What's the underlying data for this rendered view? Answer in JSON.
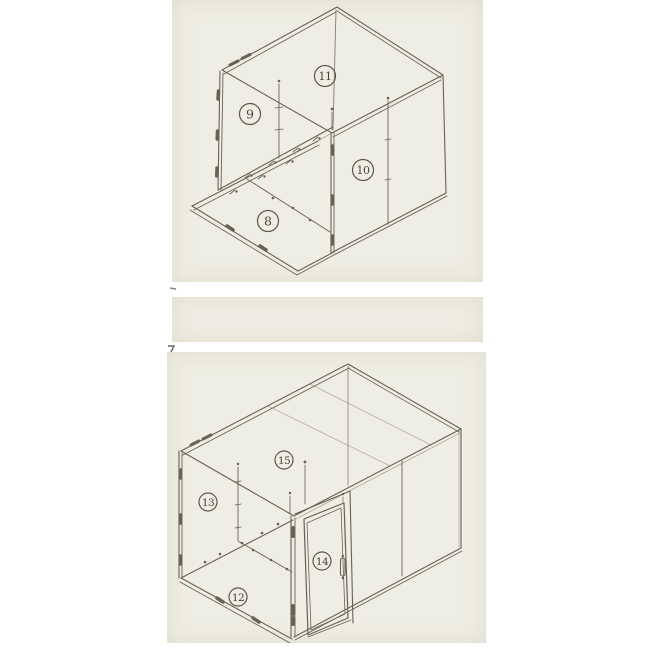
{
  "document": {
    "kind": "technical line drawing, two isometric views of panel-built cold room",
    "background_color": "#ffffff",
    "paper_color": "#efeee4",
    "line_color": "#5b574b"
  },
  "figure_top": {
    "description": "exploded isometric view: floor panel, rear wall, side wall, roof",
    "callouts": [
      {
        "label": "8"
      },
      {
        "label": "9"
      },
      {
        "label": "10"
      },
      {
        "label": "11"
      }
    ]
  },
  "figure_bottom": {
    "description": "assembled isometric view with hinged door",
    "callouts": [
      {
        "label": "12"
      },
      {
        "label": "13"
      },
      {
        "label": "14"
      },
      {
        "label": "15"
      }
    ]
  }
}
